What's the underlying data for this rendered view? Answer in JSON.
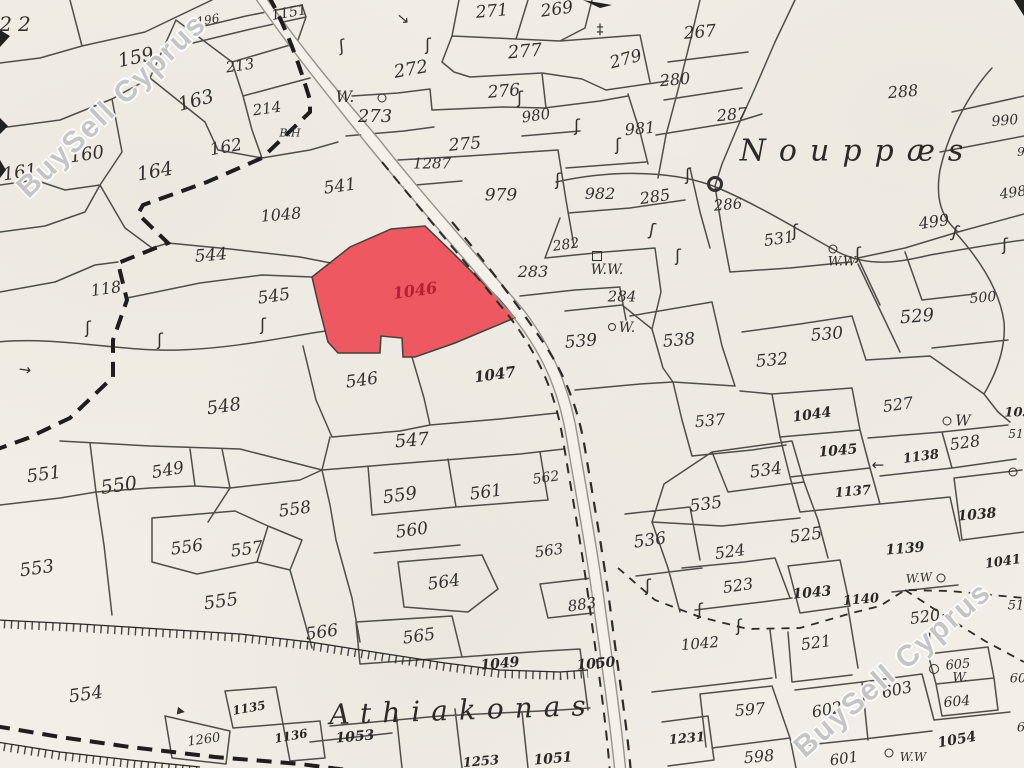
{
  "map": {
    "background_color": "#f2efe8",
    "line_color": "#3a3833",
    "highlight": {
      "number": "1046",
      "fill": "#ef515b",
      "text_color": "#b5202f",
      "label_x": 415,
      "label_y": 291,
      "label_rot": -8,
      "label_size": 16
    },
    "watermark": {
      "text": "BuySell Cyprus",
      "color": "rgba(140,140,140,0.5)",
      "instances": [
        {
          "x": 112,
          "y": 106,
          "rot": -44,
          "size": 30
        },
        {
          "x": 893,
          "y": 670,
          "rot": -41,
          "size": 30
        }
      ]
    },
    "place_names": [
      {
        "text": "Nouppæs",
        "x": 858,
        "y": 151,
        "size": 30,
        "ls": 13,
        "rot": 0
      },
      {
        "text": "Athiakonas",
        "x": 463,
        "y": 710,
        "size": 28,
        "ls": 11,
        "rot": -2
      }
    ],
    "labels": [
      {
        "t": "22",
        "x": 18,
        "y": 24,
        "s": 20,
        "r": 0,
        "ls": 6
      },
      {
        "t": "159",
        "x": 136,
        "y": 58,
        "s": 19,
        "r": -12
      },
      {
        "t": "196",
        "x": 208,
        "y": 20,
        "s": 12,
        "r": -10
      },
      {
        "t": "1151",
        "x": 289,
        "y": 13,
        "s": 14,
        "r": -10
      },
      {
        "t": "213",
        "x": 240,
        "y": 66,
        "s": 15,
        "r": -8
      },
      {
        "t": "163",
        "x": 196,
        "y": 101,
        "s": 19,
        "r": -15
      },
      {
        "t": "214",
        "x": 267,
        "y": 109,
        "s": 15,
        "r": -8
      },
      {
        "t": "B.H",
        "x": 290,
        "y": 133,
        "s": 11,
        "r": 0,
        "k": "w"
      },
      {
        "t": "162",
        "x": 226,
        "y": 148,
        "s": 17,
        "r": -10
      },
      {
        "t": "164",
        "x": 155,
        "y": 172,
        "s": 19,
        "r": -10
      },
      {
        "t": "160",
        "x": 87,
        "y": 155,
        "s": 18,
        "r": -8
      },
      {
        "t": "161",
        "x": 20,
        "y": 173,
        "s": 18,
        "r": -8
      },
      {
        "t": "1048",
        "x": 281,
        "y": 215,
        "s": 16,
        "r": -5
      },
      {
        "t": "544",
        "x": 211,
        "y": 256,
        "s": 17,
        "r": -5
      },
      {
        "t": "545",
        "x": 274,
        "y": 297,
        "s": 17,
        "r": -8
      },
      {
        "t": "118",
        "x": 106,
        "y": 289,
        "s": 16,
        "r": -8
      },
      {
        "t": "541",
        "x": 340,
        "y": 187,
        "s": 17,
        "r": -8
      },
      {
        "t": "548",
        "x": 224,
        "y": 407,
        "s": 18,
        "r": -8
      },
      {
        "t": "546",
        "x": 362,
        "y": 381,
        "s": 17,
        "r": -8
      },
      {
        "t": "1047",
        "x": 495,
        "y": 375,
        "s": 15,
        "r": -8,
        "b": 1
      },
      {
        "t": "547",
        "x": 412,
        "y": 441,
        "s": 18,
        "r": -5
      },
      {
        "t": "551",
        "x": 44,
        "y": 475,
        "s": 18,
        "r": -8
      },
      {
        "t": "550",
        "x": 119,
        "y": 486,
        "s": 19,
        "r": -8
      },
      {
        "t": "549",
        "x": 168,
        "y": 471,
        "s": 17,
        "r": -10
      },
      {
        "t": "553",
        "x": 37,
        "y": 569,
        "s": 18,
        "r": -8
      },
      {
        "t": "556",
        "x": 187,
        "y": 548,
        "s": 17,
        "r": -8
      },
      {
        "t": "557",
        "x": 247,
        "y": 550,
        "s": 17,
        "r": -8
      },
      {
        "t": "558",
        "x": 295,
        "y": 510,
        "s": 17,
        "r": -8
      },
      {
        "t": "555",
        "x": 221,
        "y": 602,
        "s": 18,
        "r": -8
      },
      {
        "t": "554",
        "x": 86,
        "y": 695,
        "s": 18,
        "r": -8
      },
      {
        "t": "566",
        "x": 322,
        "y": 633,
        "s": 17,
        "r": -8
      },
      {
        "t": "565",
        "x": 419,
        "y": 637,
        "s": 17,
        "r": -8
      },
      {
        "t": "564",
        "x": 444,
        "y": 583,
        "s": 17,
        "r": -8
      },
      {
        "t": "560",
        "x": 412,
        "y": 531,
        "s": 17,
        "r": -8
      },
      {
        "t": "559",
        "x": 400,
        "y": 496,
        "s": 18,
        "r": -8
      },
      {
        "t": "561",
        "x": 486,
        "y": 493,
        "s": 17,
        "r": -8
      },
      {
        "t": "562",
        "x": 546,
        "y": 478,
        "s": 14,
        "r": -8
      },
      {
        "t": "563",
        "x": 549,
        "y": 551,
        "s": 15,
        "r": -8
      },
      {
        "t": "883",
        "x": 582,
        "y": 605,
        "s": 15,
        "r": -8
      },
      {
        "t": "1049",
        "x": 500,
        "y": 664,
        "s": 14,
        "r": -5,
        "b": 1
      },
      {
        "t": "1050",
        "x": 596,
        "y": 664,
        "s": 14,
        "r": -5,
        "b": 1
      },
      {
        "t": "1053",
        "x": 355,
        "y": 737,
        "s": 14,
        "r": -5,
        "b": 1
      },
      {
        "t": "1253",
        "x": 481,
        "y": 762,
        "s": 13,
        "r": -5,
        "b": 1
      },
      {
        "t": "1051",
        "x": 553,
        "y": 759,
        "s": 14,
        "r": -5,
        "b": 1
      },
      {
        "t": "1135",
        "x": 249,
        "y": 708,
        "s": 12,
        "r": -10,
        "b": 1
      },
      {
        "t": "1136",
        "x": 291,
        "y": 736,
        "s": 12,
        "r": -10,
        "b": 1
      },
      {
        "t": "1260",
        "x": 204,
        "y": 740,
        "s": 13,
        "r": -8
      },
      {
        "t": "271",
        "x": 492,
        "y": 12,
        "s": 17,
        "r": -5
      },
      {
        "t": "269",
        "x": 557,
        "y": 10,
        "s": 17,
        "r": -8
      },
      {
        "t": "267",
        "x": 700,
        "y": 33,
        "s": 17,
        "r": -5
      },
      {
        "t": "277",
        "x": 525,
        "y": 52,
        "s": 18,
        "r": -5
      },
      {
        "t": "279",
        "x": 626,
        "y": 60,
        "s": 17,
        "r": -15
      },
      {
        "t": "276",
        "x": 504,
        "y": 92,
        "s": 17,
        "r": -5
      },
      {
        "t": "272",
        "x": 411,
        "y": 70,
        "s": 18,
        "r": -10
      },
      {
        "t": "W.",
        "x": 345,
        "y": 97,
        "s": 16,
        "r": 0,
        "k": "w"
      },
      {
        "t": "273",
        "x": 375,
        "y": 117,
        "s": 18,
        "r": 0
      },
      {
        "t": "280",
        "x": 675,
        "y": 80,
        "s": 16,
        "r": -5
      },
      {
        "t": "287",
        "x": 732,
        "y": 115,
        "s": 16,
        "r": -5
      },
      {
        "t": "288",
        "x": 903,
        "y": 92,
        "s": 16,
        "r": -5
      },
      {
        "t": "275",
        "x": 465,
        "y": 145,
        "s": 17,
        "r": -5
      },
      {
        "t": "1287",
        "x": 432,
        "y": 164,
        "s": 15,
        "r": 0
      },
      {
        "t": "980",
        "x": 536,
        "y": 116,
        "s": 15,
        "r": -8
      },
      {
        "t": "981",
        "x": 640,
        "y": 129,
        "s": 16,
        "r": -5
      },
      {
        "t": "982",
        "x": 600,
        "y": 194,
        "s": 16,
        "r": 0
      },
      {
        "t": "979",
        "x": 501,
        "y": 196,
        "s": 17,
        "r": 0
      },
      {
        "t": "285",
        "x": 655,
        "y": 197,
        "s": 16,
        "r": -8
      },
      {
        "t": "286",
        "x": 728,
        "y": 205,
        "s": 15,
        "r": -5
      },
      {
        "t": "282",
        "x": 566,
        "y": 245,
        "s": 14,
        "r": -8
      },
      {
        "t": "283",
        "x": 533,
        "y": 272,
        "s": 16,
        "r": 0
      },
      {
        "t": "W.W.",
        "x": 607,
        "y": 270,
        "s": 14,
        "r": 0,
        "k": "w"
      },
      {
        "t": "284",
        "x": 622,
        "y": 297,
        "s": 15,
        "r": 0
      },
      {
        "t": "W.",
        "x": 627,
        "y": 328,
        "s": 14,
        "r": 0,
        "k": "w"
      },
      {
        "t": "539",
        "x": 581,
        "y": 342,
        "s": 17,
        "r": -5
      },
      {
        "t": "538",
        "x": 679,
        "y": 341,
        "s": 17,
        "r": -5
      },
      {
        "t": "531",
        "x": 779,
        "y": 239,
        "s": 16,
        "r": -8
      },
      {
        "t": "W.W",
        "x": 842,
        "y": 262,
        "s": 13,
        "r": 0,
        "k": "w"
      },
      {
        "t": "990",
        "x": 1005,
        "y": 121,
        "s": 14,
        "r": -5
      },
      {
        "t": "499",
        "x": 934,
        "y": 222,
        "s": 16,
        "r": -8
      },
      {
        "t": "498",
        "x": 1013,
        "y": 193,
        "s": 14,
        "r": -8
      },
      {
        "t": "500",
        "x": 983,
        "y": 298,
        "s": 14,
        "r": -5
      },
      {
        "t": "9",
        "x": 1021,
        "y": 152,
        "s": 12,
        "r": 0
      },
      {
        "t": "530",
        "x": 827,
        "y": 335,
        "s": 17,
        "r": -5
      },
      {
        "t": "529",
        "x": 917,
        "y": 317,
        "s": 18,
        "r": -5
      },
      {
        "t": "532",
        "x": 772,
        "y": 361,
        "s": 17,
        "r": -5
      },
      {
        "t": "527",
        "x": 898,
        "y": 405,
        "s": 16,
        "r": -8
      },
      {
        "t": "1044",
        "x": 812,
        "y": 415,
        "s": 14,
        "r": -8,
        "b": 1
      },
      {
        "t": "537",
        "x": 710,
        "y": 421,
        "s": 16,
        "r": -5
      },
      {
        "t": "1045",
        "x": 838,
        "y": 451,
        "s": 14,
        "r": -5,
        "b": 1
      },
      {
        "t": "1137",
        "x": 853,
        "y": 492,
        "s": 13,
        "r": -5,
        "b": 1
      },
      {
        "t": "1138",
        "x": 921,
        "y": 457,
        "s": 13,
        "r": -8,
        "b": 1
      },
      {
        "t": "528",
        "x": 965,
        "y": 443,
        "s": 16,
        "r": -8
      },
      {
        "t": "W",
        "x": 963,
        "y": 421,
        "s": 15,
        "r": 0,
        "k": "w"
      },
      {
        "t": "1038",
        "x": 977,
        "y": 515,
        "s": 14,
        "r": -5,
        "b": 1
      },
      {
        "t": "1139",
        "x": 905,
        "y": 549,
        "s": 14,
        "r": -5,
        "b": 1
      },
      {
        "t": "525",
        "x": 806,
        "y": 536,
        "s": 17,
        "r": -8
      },
      {
        "t": "524",
        "x": 730,
        "y": 552,
        "s": 16,
        "r": -8
      },
      {
        "t": "523",
        "x": 738,
        "y": 586,
        "s": 16,
        "r": -8
      },
      {
        "t": "1043",
        "x": 812,
        "y": 593,
        "s": 14,
        "r": -5,
        "b": 1
      },
      {
        "t": "1140",
        "x": 861,
        "y": 600,
        "s": 13,
        "r": -5,
        "b": 1
      },
      {
        "t": "W.W",
        "x": 919,
        "y": 578,
        "s": 12,
        "r": -5,
        "k": "w"
      },
      {
        "t": "1041",
        "x": 1003,
        "y": 562,
        "s": 13,
        "r": -8,
        "b": 1
      },
      {
        "t": "536",
        "x": 650,
        "y": 541,
        "s": 17,
        "r": -8
      },
      {
        "t": "535",
        "x": 706,
        "y": 505,
        "s": 17,
        "r": -8
      },
      {
        "t": "534",
        "x": 766,
        "y": 471,
        "s": 17,
        "r": -8
      },
      {
        "t": "521",
        "x": 816,
        "y": 643,
        "s": 16,
        "r": -8
      },
      {
        "t": "520",
        "x": 925,
        "y": 617,
        "s": 16,
        "r": -8
      },
      {
        "t": "1042",
        "x": 700,
        "y": 644,
        "s": 15,
        "r": -5
      },
      {
        "t": "597",
        "x": 750,
        "y": 710,
        "s": 16,
        "r": -5
      },
      {
        "t": "598",
        "x": 759,
        "y": 757,
        "s": 16,
        "r": -5
      },
      {
        "t": "602",
        "x": 827,
        "y": 710,
        "s": 16,
        "r": -10
      },
      {
        "t": "603",
        "x": 897,
        "y": 690,
        "s": 16,
        "r": -12
      },
      {
        "t": "601",
        "x": 844,
        "y": 759,
        "s": 15,
        "r": -8
      },
      {
        "t": "605",
        "x": 958,
        "y": 665,
        "s": 13,
        "r": -5
      },
      {
        "t": "W.",
        "x": 960,
        "y": 678,
        "s": 13,
        "r": 0,
        "k": "w"
      },
      {
        "t": "604",
        "x": 957,
        "y": 702,
        "s": 14,
        "r": -5
      },
      {
        "t": "1054",
        "x": 957,
        "y": 740,
        "s": 14,
        "r": -10,
        "b": 1
      },
      {
        "t": "W.W",
        "x": 913,
        "y": 757,
        "s": 12,
        "r": 0,
        "k": "w"
      },
      {
        "t": "1231",
        "x": 687,
        "y": 739,
        "s": 13,
        "r": -5,
        "b": 1
      },
      {
        "t": "105",
        "x": 1018,
        "y": 413,
        "s": 13,
        "r": 0,
        "b": 1
      },
      {
        "t": "51",
        "x": 1016,
        "y": 434,
        "s": 12,
        "r": 0
      },
      {
        "t": "51",
        "x": 1016,
        "y": 606,
        "s": 13,
        "r": 0
      },
      {
        "t": "60",
        "x": 1018,
        "y": 679,
        "s": 13,
        "r": 0
      },
      {
        "t": "6",
        "x": 1021,
        "y": 728,
        "s": 13,
        "r": 0
      }
    ],
    "symbols": [
      {
        "type": "circle",
        "x": 382,
        "y": 98,
        "s": 7
      },
      {
        "type": "circle",
        "x": 612,
        "y": 327,
        "s": 6
      },
      {
        "type": "circle",
        "x": 833,
        "y": 249,
        "s": 7
      },
      {
        "type": "circle",
        "x": 947,
        "y": 421,
        "s": 7
      },
      {
        "type": "circle",
        "x": 941,
        "y": 578,
        "s": 7
      },
      {
        "type": "circle",
        "x": 934,
        "y": 669,
        "s": 8
      },
      {
        "type": "circle",
        "x": 889,
        "y": 753,
        "s": 7
      },
      {
        "type": "circle",
        "x": 1013,
        "y": 472,
        "s": 7
      },
      {
        "type": "circleBold",
        "x": 715,
        "y": 184,
        "s": 10
      },
      {
        "type": "square",
        "x": 597,
        "y": 256,
        "s": 8
      },
      {
        "type": "squiggle",
        "x": 342,
        "y": 47,
        "r": -5
      },
      {
        "type": "squiggle",
        "x": 428,
        "y": 46,
        "r": 0
      },
      {
        "type": "squiggle",
        "x": 520,
        "y": 99,
        "r": 0
      },
      {
        "type": "squiggle",
        "x": 577,
        "y": 127,
        "r": 0
      },
      {
        "type": "squiggle",
        "x": 618,
        "y": 146,
        "r": 0
      },
      {
        "type": "squiggle",
        "x": 558,
        "y": 181,
        "r": 0
      },
      {
        "type": "squiggle",
        "x": 688,
        "y": 176,
        "r": 0
      },
      {
        "type": "squiggle",
        "x": 652,
        "y": 231,
        "r": 10
      },
      {
        "type": "squiggle",
        "x": 678,
        "y": 257,
        "r": 0
      },
      {
        "type": "squiggle",
        "x": 858,
        "y": 255,
        "r": 0
      },
      {
        "type": "squiggle",
        "x": 795,
        "y": 232,
        "r": 0
      },
      {
        "type": "squiggle",
        "x": 955,
        "y": 233,
        "r": 15
      },
      {
        "type": "squiggle",
        "x": 1005,
        "y": 246,
        "r": 0
      },
      {
        "type": "squiggle",
        "x": 88,
        "y": 329,
        "r": 0
      },
      {
        "type": "squiggle",
        "x": 160,
        "y": 341,
        "r": 0
      },
      {
        "type": "squiggle",
        "x": 263,
        "y": 326,
        "r": 0
      },
      {
        "type": "squiggle",
        "x": 648,
        "y": 587,
        "r": 0
      },
      {
        "type": "squiggle",
        "x": 700,
        "y": 611,
        "r": 0
      },
      {
        "type": "squiggle",
        "x": 739,
        "y": 627,
        "r": 0
      },
      {
        "type": "squiggle",
        "x": 930,
        "y": 640,
        "r": 0
      },
      {
        "type": "staff",
        "x": 600,
        "y": 30,
        "r": 0
      },
      {
        "type": "arrow",
        "x": 25,
        "y": 370,
        "r": 8
      },
      {
        "type": "arrow",
        "x": 403,
        "y": 19,
        "r": 40
      },
      {
        "type": "arrow",
        "x": 878,
        "y": 465,
        "r": 180
      },
      {
        "type": "tri",
        "x": 181,
        "y": 712,
        "r": 10
      }
    ]
  }
}
